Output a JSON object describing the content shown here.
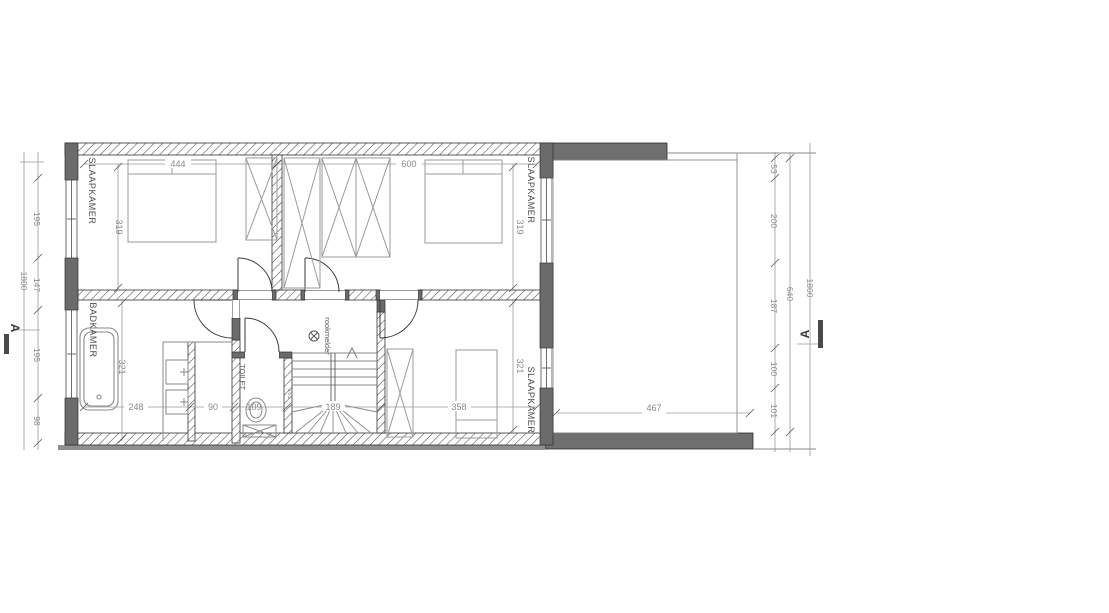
{
  "drawing": {
    "type": "floor-plan",
    "floor": "verdieping"
  },
  "rooms": {
    "bedroom1": {
      "label": "SLAAPKAMER",
      "width": "444",
      "depth": "319"
    },
    "bedroom2": {
      "label": "SLAAPKAMER",
      "width": "600",
      "depth": "319"
    },
    "bedroom3": {
      "label": "SLAAPKAMER",
      "width": "358",
      "depth": "321"
    },
    "bathroom": {
      "label": "BADKAMER",
      "width": "248",
      "depth": "321",
      "niche_width": "90"
    },
    "toilet": {
      "label": "TOILET",
      "width": "109",
      "side_dim": "161"
    },
    "stairs": {
      "width": "189"
    },
    "roof": {
      "width": "467"
    }
  },
  "annotations": {
    "smoke_detector": "rookmelder"
  },
  "dimensions": {
    "left_chain": [
      "195",
      "147",
      "195",
      "98"
    ],
    "left_total": "1800",
    "right_chain": [
      "53",
      "200",
      "187",
      "100",
      "101"
    ],
    "right_mid_total": "640",
    "right_total": "1800"
  },
  "section_markers": {
    "left": "A",
    "right": "A"
  },
  "colors": {
    "wall_dark": "#6b6b6b",
    "wall_hatch_line": "#4a4a4a",
    "dim_line": "#9a9a9a",
    "furniture_line": "#9b9b9b",
    "door_line": "#3a3a3a"
  }
}
